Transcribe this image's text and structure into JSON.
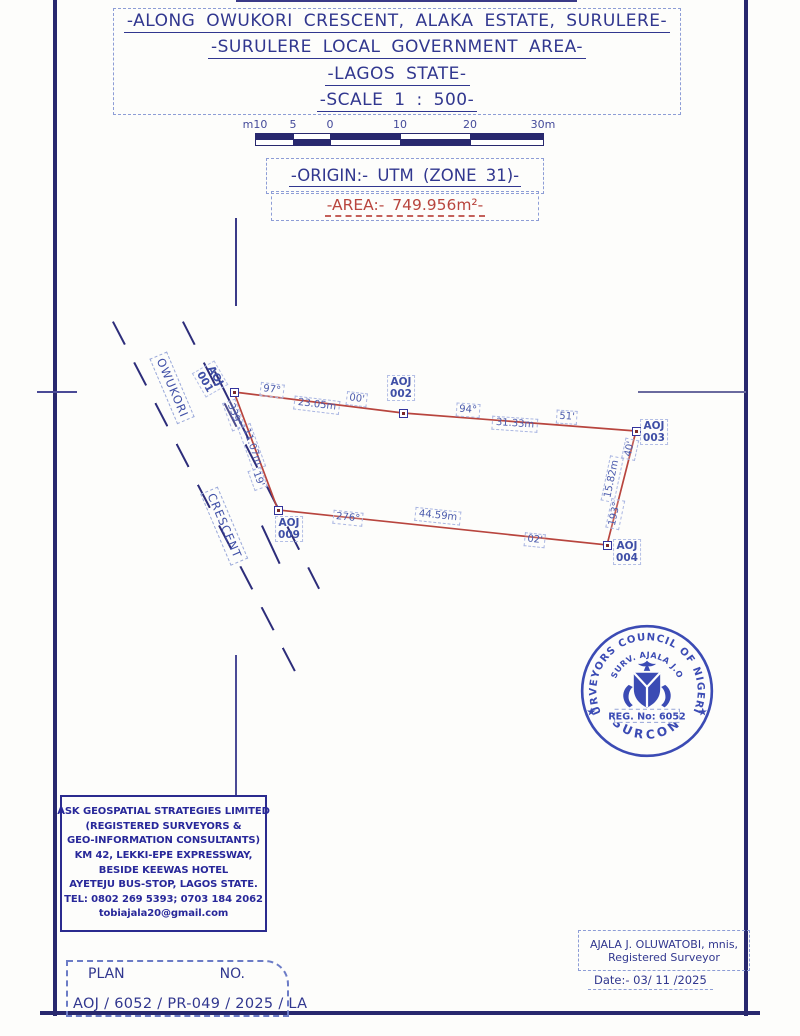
{
  "title_block": {
    "lines": [
      "-ALONG OWUKORI CRESCENT, ALAKA ESTATE, SURULERE-",
      "-SURULERE LOCAL GOVERNMENT AREA-",
      "-LAGOS STATE-",
      "-SCALE 1 : 500-"
    ]
  },
  "scale_bar": {
    "tick_labels": [
      "m10",
      "5",
      "0",
      "10",
      "20",
      "30m"
    ],
    "tick_px": [
      0,
      38,
      75,
      145,
      215,
      288
    ]
  },
  "origin_line": "-ORIGIN:- UTM (ZONE 31)-",
  "area_line": "-AREA:- 749.956m²-",
  "survey_plot": {
    "area_value": "749.956m²",
    "vertices": [
      {
        "id": "AOJ 001",
        "x": 234,
        "y": 392
      },
      {
        "id": "AOJ 002",
        "x": 403,
        "y": 413
      },
      {
        "id": "AOJ 003",
        "x": 636,
        "y": 431
      },
      {
        "id": "AOJ 004",
        "x": 607,
        "y": 545
      },
      {
        "id": "AOJ 009",
        "x": 278,
        "y": 510
      }
    ],
    "edges": [
      {
        "from": "AOJ 001",
        "to": "AOJ 002",
        "bearing": "97° 00'",
        "distance": "23.05m"
      },
      {
        "from": "AOJ 002",
        "to": "AOJ 003",
        "bearing": "94° 51'",
        "distance": "31.33m"
      },
      {
        "from": "AOJ 003",
        "to": "AOJ 004",
        "bearing": "193° 40'",
        "distance": "15.82m"
      },
      {
        "from": "AOJ 009",
        "to": "AOJ 004",
        "bearing": "276° 02'",
        "distance": "44.59m"
      },
      {
        "from": "AOJ 001",
        "to": "AOJ 009",
        "bearing": "339° 19'",
        "distance": "11.07m"
      }
    ],
    "texts": [
      {
        "t": "AOJ\n001",
        "x": 210,
        "y": 379,
        "r": 60,
        "c": "pt"
      },
      {
        "t": "AOJ\n002",
        "x": 401,
        "y": 388,
        "r": 0,
        "c": "pt"
      },
      {
        "t": "AOJ\n003",
        "x": 654,
        "y": 432,
        "r": 0,
        "c": "pt"
      },
      {
        "t": "AOJ\n004",
        "x": 627,
        "y": 552,
        "r": 0,
        "c": "pt"
      },
      {
        "t": "AOJ\n009",
        "x": 289,
        "y": 529,
        "r": 0,
        "c": "pt"
      },
      {
        "t": "97°",
        "x": 272,
        "y": 390,
        "r": 7,
        "c": "brg"
      },
      {
        "t": "23.05m",
        "x": 317,
        "y": 405,
        "r": 7,
        "c": "dist"
      },
      {
        "t": "00'",
        "x": 357,
        "y": 399,
        "r": 7,
        "c": "brg"
      },
      {
        "t": "94°",
        "x": 468,
        "y": 410,
        "r": 4,
        "c": "brg"
      },
      {
        "t": "31.33m",
        "x": 515,
        "y": 424,
        "r": 4,
        "c": "dist"
      },
      {
        "t": "51'",
        "x": 567,
        "y": 417,
        "r": 4,
        "c": "brg"
      },
      {
        "t": "40'",
        "x": 630,
        "y": 449,
        "r": -78,
        "c": "brg"
      },
      {
        "t": "15.82m",
        "x": 612,
        "y": 479,
        "r": -78,
        "c": "dist"
      },
      {
        "t": "193°",
        "x": 615,
        "y": 514,
        "r": -78,
        "c": "brg"
      },
      {
        "t": "276°",
        "x": 348,
        "y": 518,
        "r": 6,
        "c": "brg"
      },
      {
        "t": "44.59m",
        "x": 438,
        "y": 516,
        "r": 6,
        "c": "dist"
      },
      {
        "t": "02'",
        "x": 535,
        "y": 540,
        "r": 6,
        "c": "brg"
      },
      {
        "t": "339°",
        "x": 234,
        "y": 415,
        "r": 70,
        "c": "brg"
      },
      {
        "t": "11.07m",
        "x": 252,
        "y": 447,
        "r": 70,
        "c": "dist"
      },
      {
        "t": "19'",
        "x": 258,
        "y": 479,
        "r": 70,
        "c": "brg"
      },
      {
        "t": "OWUKORI",
        "x": 172,
        "y": 388,
        "r": 67,
        "c": "road"
      },
      {
        "t": "CRESCENT",
        "x": 224,
        "y": 526,
        "r": 67,
        "c": "road"
      }
    ],
    "boundary_color": "#b8453e"
  },
  "seal": {
    "ring_text": "SURVEYORS  COUNCIL  OF  NIGERIA",
    "bottom_text": "SURCON",
    "inner_text": "SURV.  AJALA  J.O",
    "reg_text": "REG. No: 6052",
    "star_left": "★",
    "star_right": "★",
    "color": "#2b3cae"
  },
  "firm_box": {
    "lines": [
      "ASK GEOSPATIAL STRATEGIES LIMITED",
      "(REGISTERED SURVEYORS &",
      "GEO-INFORMATION CONSULTANTS)",
      "KM 42, LEKKI-EPE EXPRESSWAY,",
      "BESIDE KEEWAS HOTEL",
      "AYETEJU BUS-STOP, LAGOS STATE.",
      "TEL: 0802 269 5393; 0703 184 2062",
      "tobiajala20@gmail.com"
    ]
  },
  "surveyor": {
    "name": "AJALA J. OLUWATOBI, mnis,",
    "title": "Registered Surveyor",
    "date": "Date:- 03/ 11 /2025"
  },
  "plan_no": {
    "label_plan": "PLAN",
    "label_no": "NO.",
    "value": "AOJ / 6052 / PR-049 / 2025 / LA"
  }
}
